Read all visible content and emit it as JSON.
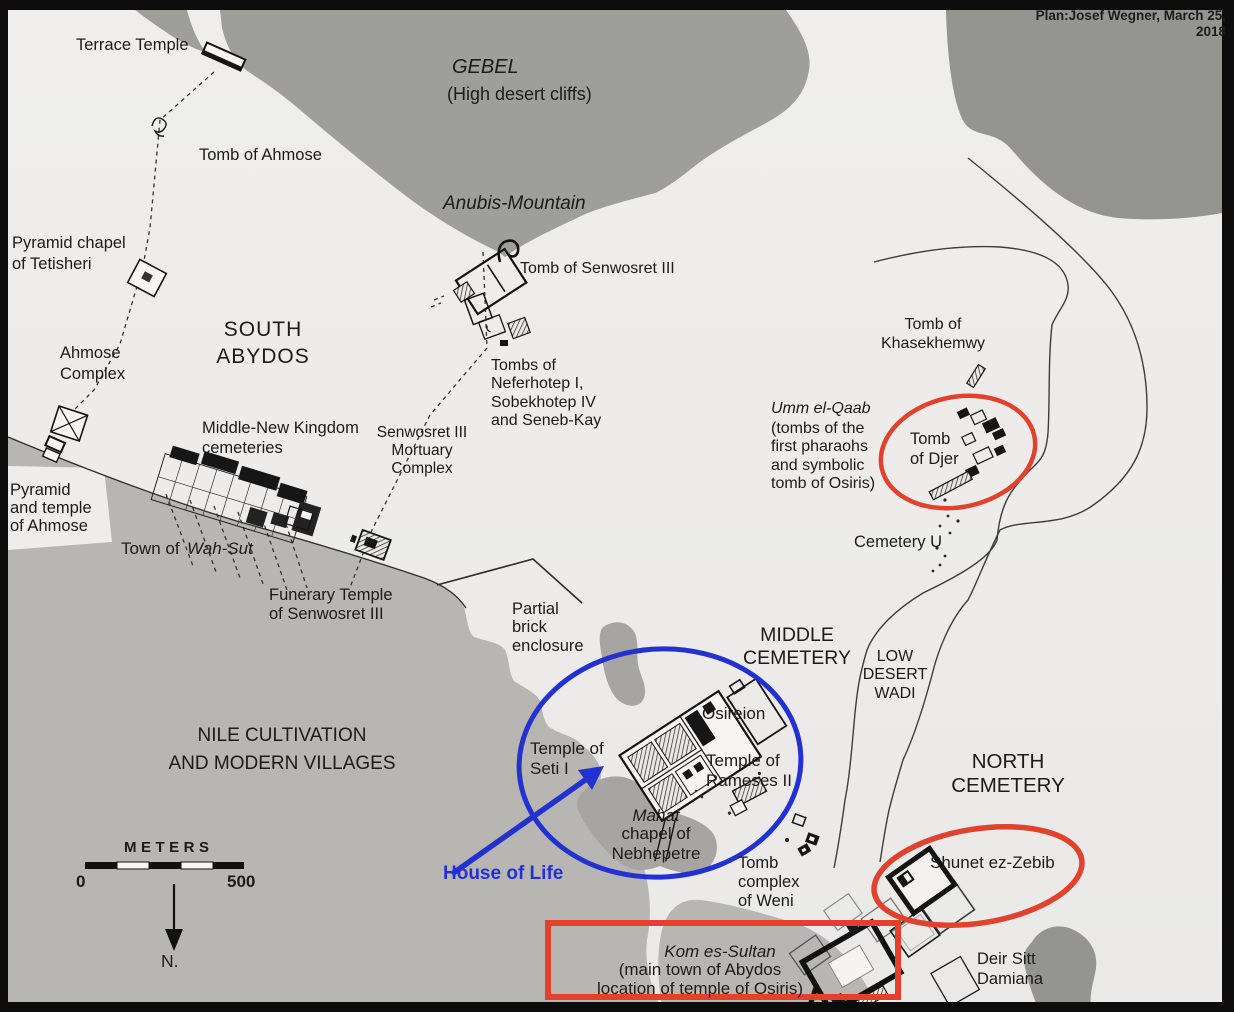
{
  "colors": {
    "paper": "#eeedeb",
    "mountain": "#9e9e9a",
    "mountain_dark": "#949490",
    "cultivation": "#b7b6b2",
    "patch": "#a6a5a1",
    "ink": "#1b1b1b",
    "red": "#e2412d",
    "blue": "#2331d1",
    "frame": "#0c0c0c"
  },
  "map_title": "Plan of Abydos archaeological site",
  "scale": {
    "unit_label": "METERS",
    "start": "0",
    "end": "500",
    "north": "N."
  },
  "annotations": {
    "red_ellipses": [
      "Tomb of Djer",
      "Shunet ez-Zebib"
    ],
    "red_rectangle": "Kom es-Sultan",
    "blue_ellipse": "Temple of Seti I / Osireion / Temple of Rameses II",
    "blue_arrow_label": "House of Life"
  },
  "labels": [
    {
      "id": "credit",
      "text": "Plan:Josef Wegner, March 25, 2018",
      "x": 1012,
      "y": 8,
      "size": 13.5,
      "bold": true,
      "w": 214,
      "align": "right"
    },
    {
      "id": "terrace-temple",
      "text": "Terrace Temple",
      "x": 76,
      "y": 36,
      "size": 16.5
    },
    {
      "id": "gebel-title",
      "text": "GEBEL",
      "x": 452,
      "y": 56,
      "size": 20,
      "italic": true
    },
    {
      "id": "gebel-subtitle",
      "text": "(High desert cliffs)",
      "x": 447,
      "y": 84,
      "size": 18
    },
    {
      "id": "tomb-of-ahmose",
      "text": "Tomb of Ahmose",
      "x": 199,
      "y": 146,
      "size": 16.5
    },
    {
      "id": "anubis-mountain",
      "text": "Anubis-Mountain",
      "x": 443,
      "y": 193,
      "size": 19,
      "italic": true
    },
    {
      "id": "pyramid-chapel-tetisheri",
      "text": "Pyramid chapel\nof Tetisheri",
      "x": 12,
      "y": 233,
      "size": 16.5,
      "lh": 1.25
    },
    {
      "id": "tomb-of-senwosret-iii",
      "text": "Tomb of Senwosret III",
      "x": 520,
      "y": 260,
      "size": 16
    },
    {
      "id": "south-abydos",
      "text": "SOUTH\nABYDOS",
      "x": 203,
      "y": 316,
      "size": 21,
      "w": 120,
      "align": "center",
      "ls": 1,
      "lh": 1.3
    },
    {
      "id": "ahmose-complex",
      "text": "Ahmose\nComplex",
      "x": 60,
      "y": 343,
      "size": 16.5,
      "lh": 1.3
    },
    {
      "id": "tombs-neferhotep",
      "text": "Tombs of\nNeferhotep I,\nSobekhotep IV\nand Seneb-Kay",
      "x": 491,
      "y": 357,
      "size": 16,
      "lh": 1.15
    },
    {
      "id": "tomb-of-khasekhemwy",
      "text": "Tomb of\nKhasekhemwy",
      "x": 872,
      "y": 315,
      "size": 16,
      "w": 122,
      "align": "center",
      "lh": 1.2
    },
    {
      "id": "middle-new-kingdom-cemeteries",
      "text": "Middle-New Kingdom\ncemeteries",
      "x": 202,
      "y": 419,
      "size": 16.5,
      "lh": 1.2
    },
    {
      "id": "senwosret-mortuary-complex",
      "text": "Senwosret III\nMortuary\nComplex",
      "x": 376,
      "y": 424,
      "size": 15.5,
      "w": 92,
      "align": "center",
      "lh": 1.15
    },
    {
      "id": "umm-el-qaab",
      "text": "Umm el-Qaab",
      "x": 771,
      "y": 400,
      "size": 16,
      "italic": true
    },
    {
      "id": "umm-el-qaab-desc",
      "text": "(tombs of the\nfirst pharaohs\nand symbolic\ntomb of Osiris)",
      "x": 771,
      "y": 420,
      "size": 16,
      "lh": 1.15
    },
    {
      "id": "tomb-of-djer",
      "text": "Tomb\nof Djer",
      "x": 910,
      "y": 430,
      "size": 16.5,
      "lh": 1.2
    },
    {
      "id": "pyramid-temple-ahmose",
      "text": "Pyramid\nand temple\nof Ahmose",
      "x": 10,
      "y": 481,
      "size": 16.5,
      "lh": 1.1
    },
    {
      "id": "cemetery-u",
      "text": "Cemetery U",
      "x": 854,
      "y": 533,
      "size": 16.5
    },
    {
      "id": "town-of",
      "text": "Town of",
      "x": 121,
      "y": 539,
      "size": 17
    },
    {
      "id": "wah-sut",
      "text": "Wah-Sut",
      "x": 187,
      "y": 539,
      "size": 17,
      "italic": true
    },
    {
      "id": "funerary-temple-senwosret",
      "text": "Funerary Temple\nof Senwosret III",
      "x": 269,
      "y": 586,
      "size": 16.5,
      "lh": 1.15
    },
    {
      "id": "partial-brick-enclosure",
      "text": "Partial\nbrick\nenclosure",
      "x": 512,
      "y": 600,
      "size": 16.5,
      "lh": 1.12
    },
    {
      "id": "middle-cemetery",
      "text": "MIDDLE\nCEMETERY",
      "x": 737,
      "y": 624,
      "size": 19.5,
      "w": 120,
      "align": "center",
      "lh": 1.2
    },
    {
      "id": "low-desert-wadi",
      "text": "LOW\nDESERT\nWADI",
      "x": 857,
      "y": 648,
      "size": 16,
      "w": 76,
      "align": "center",
      "lh": 1.15
    },
    {
      "id": "nile-cultivation",
      "text": "NILE CULTIVATION\nAND MODERN VILLAGES",
      "x": 160,
      "y": 722,
      "size": 19,
      "w": 244,
      "align": "center",
      "lh": 1.45
    },
    {
      "id": "osireion",
      "text": "Osireion",
      "x": 702,
      "y": 704,
      "size": 17
    },
    {
      "id": "temple-of-seti",
      "text": "Temple of\nSeti I",
      "x": 530,
      "y": 739,
      "size": 17,
      "lh": 1.15
    },
    {
      "id": "temple-of-rameses",
      "text": "Temple of\nRameses II",
      "x": 706,
      "y": 751,
      "size": 17,
      "lh": 1.15
    },
    {
      "id": "north-cemetery",
      "text": "NORTH\nCEMETERY",
      "x": 948,
      "y": 750,
      "size": 20.5,
      "w": 120,
      "align": "center",
      "lh": 1.18
    },
    {
      "id": "mahat",
      "text": "Mahat",
      "x": 628,
      "y": 806,
      "size": 17,
      "italic": true,
      "w": 56,
      "align": "center"
    },
    {
      "id": "mahat-desc",
      "text": "chapel of\nNebhepetre",
      "x": 606,
      "y": 824,
      "size": 17,
      "w": 100,
      "align": "center",
      "lh": 1.15
    },
    {
      "id": "house-of-life",
      "text": "House of Life",
      "x": 443,
      "y": 863,
      "size": 19,
      "bold": true,
      "color": "#2331d1"
    },
    {
      "id": "tomb-complex-weni",
      "text": "Tomb\ncomplex\nof Weni",
      "x": 738,
      "y": 854,
      "size": 16.5,
      "lh": 1.15
    },
    {
      "id": "shunet-ez-zebib",
      "text": "Shunet ez-Zebib",
      "x": 930,
      "y": 853,
      "size": 17
    },
    {
      "id": "kom-es-sultan",
      "text": "Kom es-Sultan",
      "x": 600,
      "y": 942,
      "size": 17,
      "italic": true,
      "w": 240,
      "align": "center"
    },
    {
      "id": "kom-es-sultan-desc",
      "text": "(main town of Abydos\nlocation of temple of Osiris)",
      "x": 580,
      "y": 961,
      "size": 17,
      "w": 240,
      "align": "center",
      "lh": 1.1
    },
    {
      "id": "deir-sitt-damiana",
      "text": "Deir Sitt\nDamiana",
      "x": 977,
      "y": 950,
      "size": 16.5,
      "lh": 1.2
    },
    {
      "id": "meters",
      "text": "METERS",
      "x": 124,
      "y": 839,
      "size": 15,
      "bold": true,
      "ls": 4.5
    },
    {
      "id": "scale-0",
      "text": "0",
      "x": 76,
      "y": 872,
      "size": 17,
      "bold": true
    },
    {
      "id": "scale-500",
      "text": "500",
      "x": 227,
      "y": 872,
      "size": 17,
      "bold": true
    },
    {
      "id": "north-label",
      "text": "N.",
      "x": 161,
      "y": 951,
      "size": 17.5
    }
  ]
}
